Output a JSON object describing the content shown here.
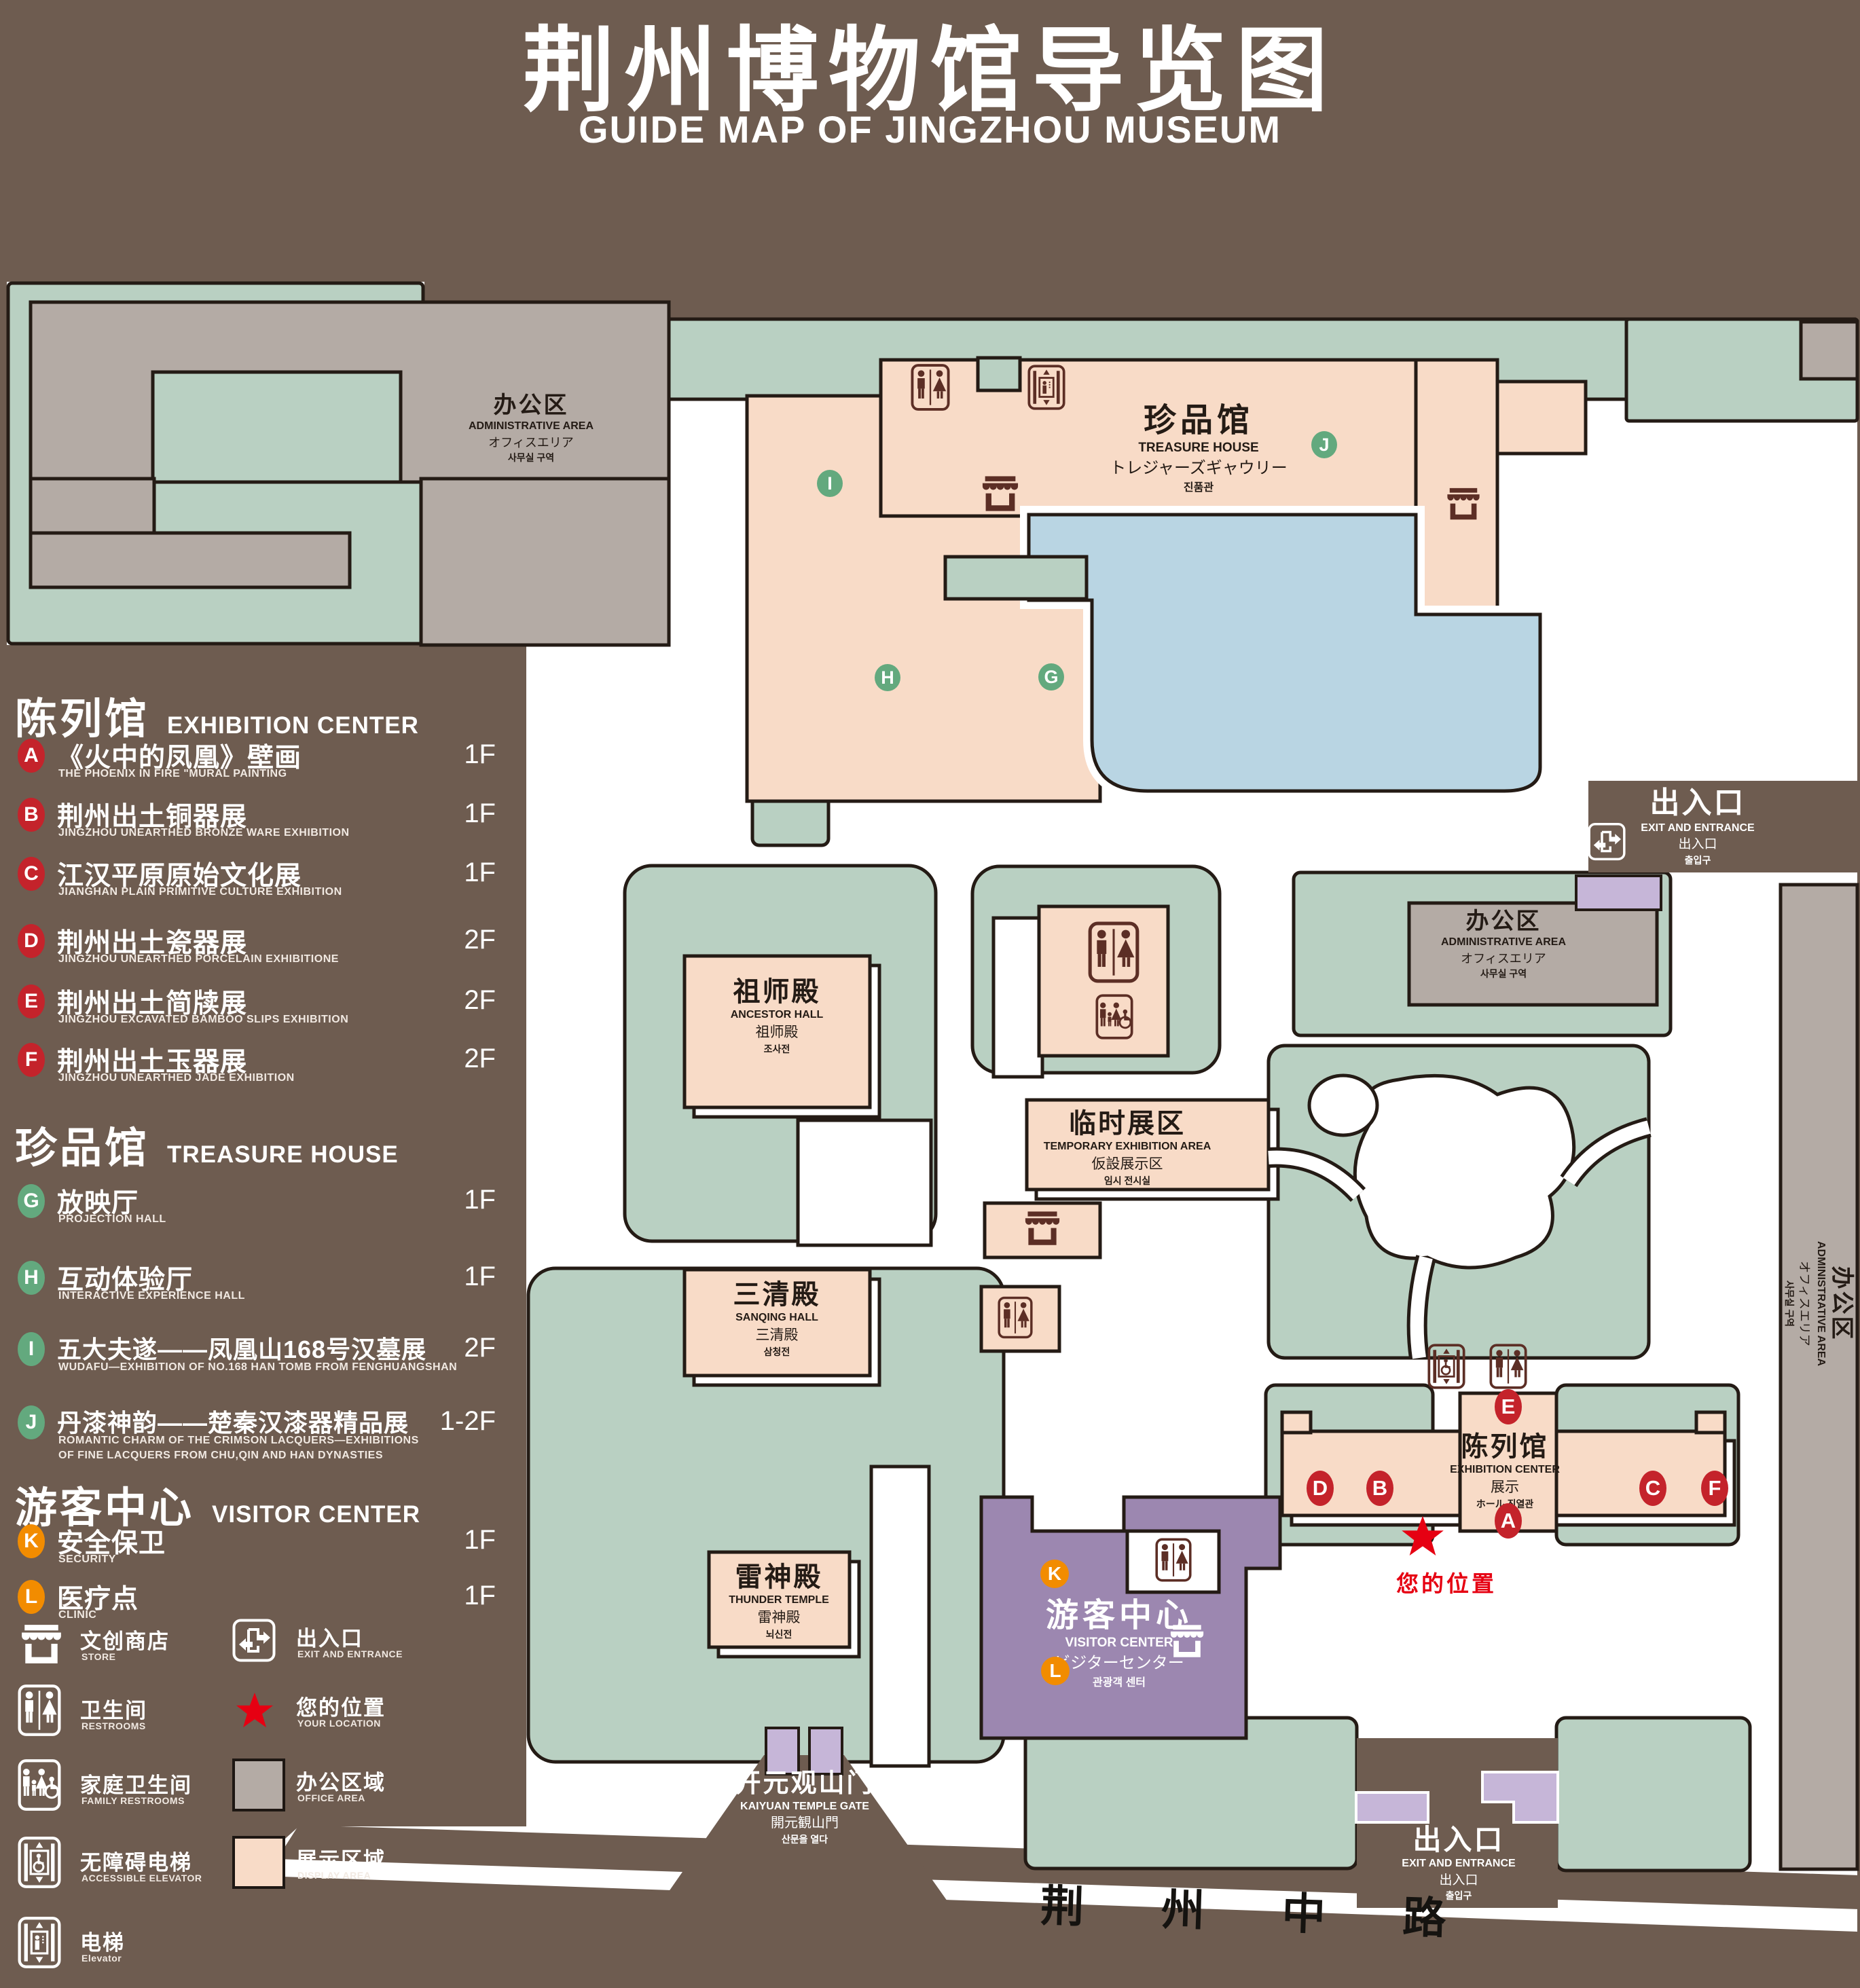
{
  "title": {
    "zh": "荆州博物馆导览图",
    "en": "GUIDE MAP OF JINGZHOU MUSEUM"
  },
  "legend": {
    "section1": {
      "zh": "陈列馆",
      "en": "EXHIBITION CENTER",
      "items": [
        {
          "letter": "A",
          "zh": "《火中的凤凰》壁画",
          "en": "THE PHOENIX IN FIRE \"MURAL PAINTING",
          "floor": "1F"
        },
        {
          "letter": "B",
          "zh": "荆州出土铜器展",
          "en": "JINGZHOU UNEARTHED BRONZE WARE EXHIBITION",
          "floor": "1F"
        },
        {
          "letter": "C",
          "zh": "江汉平原原始文化展",
          "en": "JIANGHAN PLAIN PRIMITIVE CULTURE EXHIBITION",
          "floor": "1F"
        },
        {
          "letter": "D",
          "zh": "荆州出土瓷器展",
          "en": "JINGZHOU UNEARTHED PORCELAIN EXHIBITIONE",
          "floor": "2F"
        },
        {
          "letter": "E",
          "zh": "荆州出土简牍展",
          "en": "JINGZHOU EXCAVATED BAMBOO SLIPS EXHIBITION",
          "floor": "2F"
        },
        {
          "letter": "F",
          "zh": "荆州出土玉器展",
          "en": "JINGZHOU UNEARTHED JADE EXHIBITION",
          "floor": "2F"
        }
      ]
    },
    "section2": {
      "zh": "珍品馆",
      "en": "TREASURE HOUSE",
      "items": [
        {
          "letter": "G",
          "zh": "放映厅",
          "en": "PROJECTION HALL",
          "floor": "1F"
        },
        {
          "letter": "H",
          "zh": "互动体验厅",
          "en": "INTERACTIVE EXPERIENCE HALL",
          "floor": "1F"
        },
        {
          "letter": "I",
          "zh": "五大夫遂——凤凰山168号汉墓展",
          "en": "WUDAFU—EXHIBITION OF NO.168 HAN TOMB FROM FENGHUANGSHAN",
          "floor": "2F"
        },
        {
          "letter": "J",
          "zh": "丹漆神韵——楚秦汉漆器精品展",
          "en": "ROMANTIC CHARM OF THE CRIMSON LACQUERS—EXHIBITIONS",
          "en2": "OF FINE LACQUERS FROM CHU,QIN AND HAN DYNASTIES",
          "floor": "1-2F"
        }
      ]
    },
    "section3": {
      "zh": "游客中心",
      "en": "VISITOR CENTER",
      "items": [
        {
          "letter": "K",
          "zh": "安全保卫",
          "en": "SECURITY",
          "floor": "1F"
        },
        {
          "letter": "L",
          "zh": "医疗点",
          "en": "CLINIC",
          "floor": "1F"
        }
      ]
    },
    "symbols": {
      "store": {
        "zh": "文创商店",
        "en": "STORE"
      },
      "exit": {
        "zh": "出入口",
        "en": "EXIT AND ENTRANCE"
      },
      "restroom": {
        "zh": "卫生间",
        "en": "RESTROOMS"
      },
      "location": {
        "zh": "您的位置",
        "en": "YOUR LOCATION"
      },
      "family": {
        "zh": "家庭卫生间",
        "en": "FAMILY RESTROOMS"
      },
      "office": {
        "zh": "办公区域",
        "en": "OFFICE AREA"
      },
      "accessible": {
        "zh": "无障碍电梯",
        "en": "ACCESSIBLE ELEVATOR"
      },
      "display": {
        "zh": "展示区域",
        "en": "DISPLAY AREA"
      },
      "elevator": {
        "zh": "电梯",
        "en": "Elevator"
      }
    },
    "colors": {
      "red": "#c4232b",
      "green": "#63a97e",
      "orange": "#f28c00",
      "lawn": "#b9d0c2",
      "displayArea": "#f8dbc7",
      "officeArea": "#b4aba5",
      "lake": "#b9d5e3",
      "visitor": "#9c87b0",
      "background": "#6e5c50",
      "locationRed": "#e60012"
    }
  },
  "map": {
    "admin_nw": {
      "zh": "办公区",
      "en": "ADMINISTRATIVE AREA",
      "ja": "オフィスエリア",
      "ko": "사무실 구역"
    },
    "treasure": {
      "zh": "珍品馆",
      "en": "TREASURE HOUSE",
      "ja": "トレジャーズギャウリー",
      "ko": "진품관"
    },
    "ancestor": {
      "zh": "祖师殿",
      "en": "ANCESTOR HALL",
      "ja": "祖师殿",
      "ko": "조사전"
    },
    "temporary": {
      "zh": "临时展区",
      "en": "TEMPORARY EXHIBITION AREA",
      "ja": "仮設展示区",
      "ko": "임시 전시실"
    },
    "sanqing": {
      "zh": "三清殿",
      "en": "SANQING HALL",
      "ja": "三清殿",
      "ko": "삼청전"
    },
    "thunder": {
      "zh": "雷神殿",
      "en": "THUNDER TEMPLE",
      "ja": "雷神殿",
      "ko": "뇌신전"
    },
    "visitor": {
      "zh": "游客中心",
      "en": "VISITOR CENTER",
      "ja": "ビジターセンター",
      "ko": "관광객 센터"
    },
    "admin_mid": {
      "zh": "办公区",
      "en": "ADMINISTRATIVE AREA",
      "ja": "オフィスエリア",
      "ko": "사무실 구역"
    },
    "admin_east": {
      "zh": "办公区",
      "en": "ADMINISTRATIVE AREA",
      "ja": "オフィスエリア",
      "ko": "사무실 구역"
    },
    "exhibition": {
      "zh": "陈列馆",
      "en": "EXHIBITION CENTER",
      "ja": "展示",
      "ko": "ホール 진열관"
    },
    "exit_east": {
      "zh": "出入口",
      "en": "EXIT AND ENTRANCE",
      "ja": "出入口",
      "ko": "출입구"
    },
    "exit_south": {
      "zh": "出入口",
      "en": "EXIT AND ENTRANCE",
      "ja": "出入口",
      "ko": "출입구"
    },
    "gate": {
      "zh": "开元观山门",
      "en": "KAIYUAN TEMPLE GATE",
      "ja": "開元観山門",
      "ko": "산문을 열다"
    },
    "road": {
      "name": "荆 州 中 路"
    },
    "your_location": "您的位置",
    "markers": {
      "a": "A",
      "b": "B",
      "c": "C",
      "d": "D",
      "e": "E",
      "f": "F",
      "g": "G",
      "h": "H",
      "i": "I",
      "j": "J",
      "k": "K",
      "l": "L"
    }
  }
}
